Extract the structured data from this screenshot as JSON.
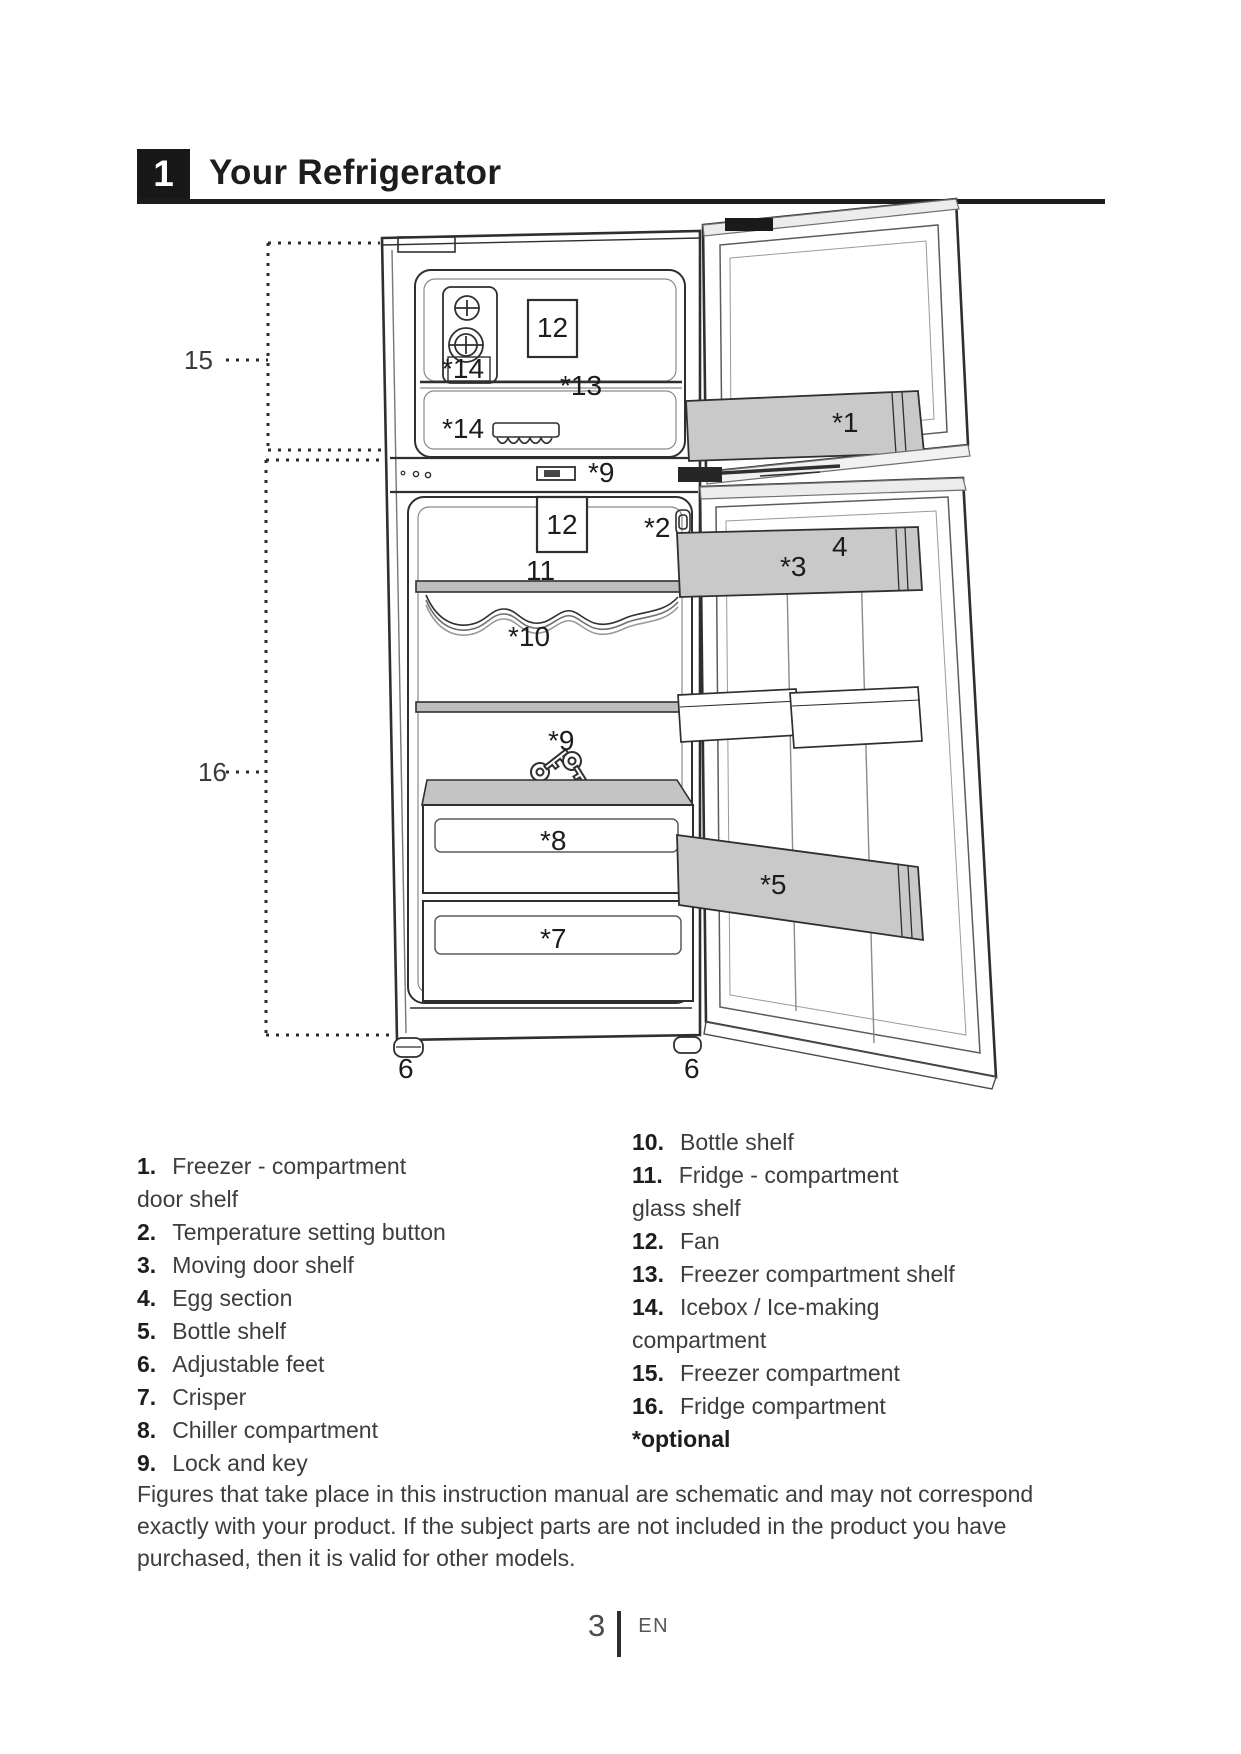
{
  "page": {
    "header": {
      "section_number": "1",
      "title": "Your Refrigerator"
    },
    "page_footer": {
      "page_number": "3",
      "language_code": "EN"
    }
  },
  "diagram": {
    "labels": {
      "freezer_compartment_bracket": "15",
      "fridge_compartment_bracket": "16",
      "freezer_fan": "12",
      "icebox_upper": "*14",
      "freezer_shelf": "*13",
      "icebox_lower": "*14",
      "freezer_door_shelf": "*1",
      "lock": "*9",
      "fridge_fan": "12",
      "temperature_button": "*2",
      "egg_section": "4",
      "moving_door_shelf": "*3",
      "glass_shelf": "11",
      "wire_bottle_shelf": "*10",
      "lock_and_key": "*9",
      "chiller_compartment": "*8",
      "door_bottle_shelf": "*5",
      "crisper": "*7",
      "adjustable_foot_left": "6",
      "adjustable_foot_right": "6"
    }
  },
  "legend": {
    "left_column": [
      {
        "num": "1.",
        "text": "Freezer - compartment",
        "text2": "door shelf"
      },
      {
        "num": "2.",
        "text": "Temperature setting button",
        "text2": ""
      },
      {
        "num": "3.",
        "text": "Moving door shelf",
        "text2": ""
      },
      {
        "num": "4.",
        "text": "Egg section",
        "text2": ""
      },
      {
        "num": "5.",
        "text": "Bottle shelf",
        "text2": ""
      },
      {
        "num": "6.",
        "text": "Adjustable feet",
        "text2": ""
      },
      {
        "num": "7.",
        "text": "Crisper",
        "text2": ""
      },
      {
        "num": "8.",
        "text": "Chiller compartment",
        "text2": ""
      },
      {
        "num": "9.",
        "text": "Lock and key",
        "text2": ""
      }
    ],
    "right_column": [
      {
        "num": "10.",
        "text": "Bottle shelf",
        "text2": ""
      },
      {
        "num": "11.",
        "text": "Fridge - compartment",
        "text2": "glass shelf"
      },
      {
        "num": "12.",
        "text": "Fan",
        "text2": ""
      },
      {
        "num": "13.",
        "text": "Freezer compartment shelf",
        "text2": ""
      },
      {
        "num": "14.",
        "text": "Icebox / Ice-making",
        "text2": "compartment"
      },
      {
        "num": "15.",
        "text": "Freezer compartment",
        "text2": ""
      },
      {
        "num": "16.",
        "text": "Fridge compartment",
        "text2": ""
      }
    ],
    "optional_note": "*optional"
  },
  "note": "Figures that take place in this instruction manual are schematic and may not correspond exactly with your product. If the subject parts are not included in the product you have purchased, then it is valid for other models.",
  "colors": {
    "ink": "#1d1d1d",
    "line_art": "#3a3a3a",
    "shelf_shade": "#c9c9c9",
    "background": "#ffffff"
  }
}
